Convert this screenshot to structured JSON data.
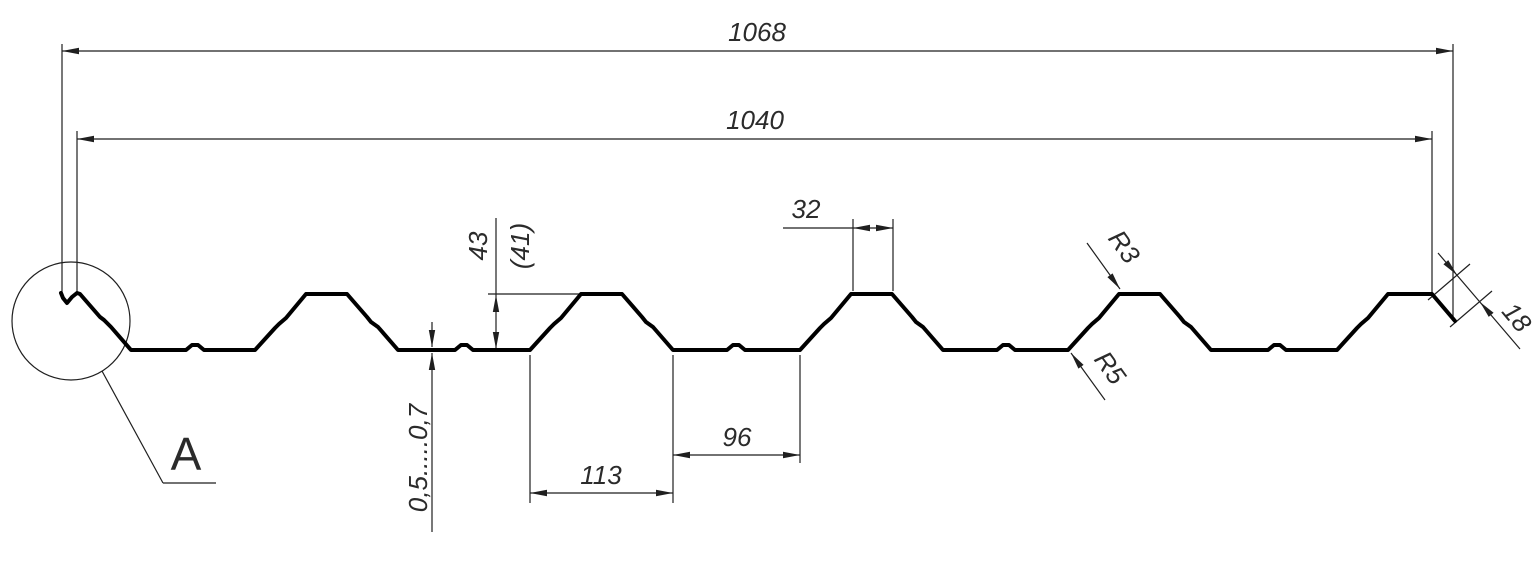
{
  "drawing": {
    "type": "trapezoidal-profile-sheet-cross-section",
    "dimensions": {
      "overall_width": "1068",
      "useful_width": "1040",
      "rib_height": "43",
      "rib_height_ref": "(41)",
      "crest_top_width": "32",
      "rib_bottom_width": "113",
      "valley_width": "96",
      "sheet_thickness": "0,5.....0,7",
      "top_corner_radius": "R3",
      "bottom_corner_radius": "R5",
      "edge_lip_length": "18"
    },
    "detail": {
      "label": "A"
    },
    "colors": {
      "background": "#ffffff",
      "profile_line": "#000000",
      "dimension_line": "#1f1f1f",
      "text": "#2b2b2b"
    }
  }
}
